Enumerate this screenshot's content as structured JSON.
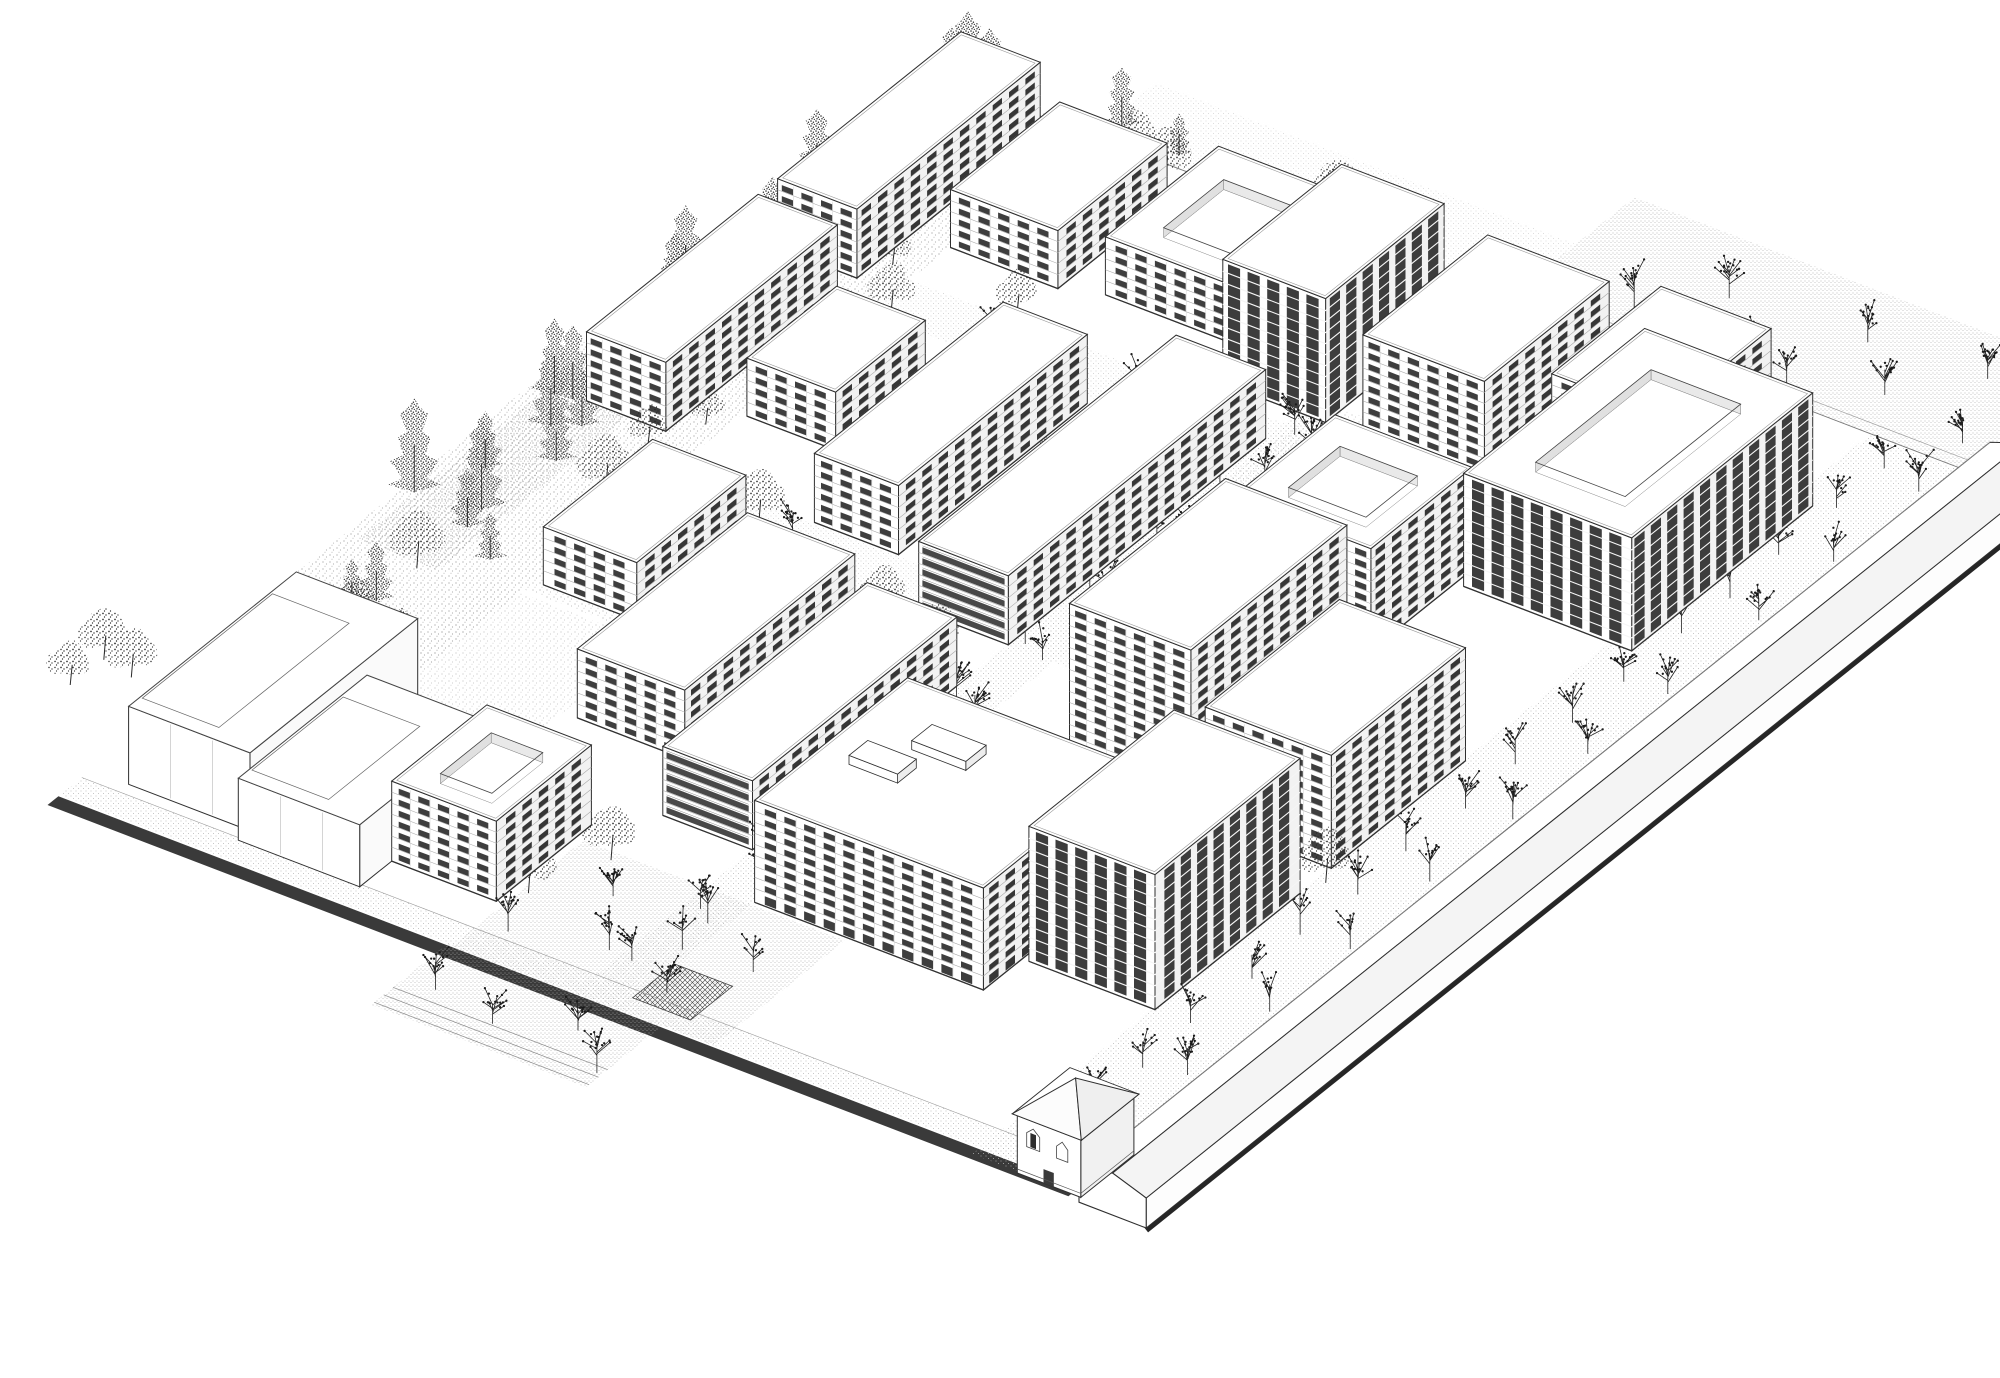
{
  "meta": {
    "drawing_kind": "black-and-white axonometric architectural masterplan line drawing",
    "width": 2000,
    "height": 1378,
    "visible_text": ""
  },
  "palette": {
    "paper": "#ffffff",
    "ink": "#2f2f2f",
    "line_light": "#a6a6a6",
    "facade_left": "#ffffff",
    "facade_right": "#f2f2f2",
    "window": "#2e2e2e",
    "window_right": "#262626",
    "dark_stripe": "#3d3d3d",
    "plinth_band": "#3a3a3a",
    "wall_shadow": "#262626",
    "trunk": "#2a2a2a"
  },
  "scene": {
    "axes": {
      "origin": [
        60,
        795
      ],
      "u": [
        0.934,
        0.358
      ],
      "v": [
        0.78,
        -0.625
      ]
    },
    "floor_height": 11,
    "bay_width": 21,
    "site": {
      "x_max": 1093,
      "y_max": 1140
    },
    "ground_patches": [
      {
        "name": "park-strip",
        "x": [
          -30,
          150
        ],
        "y": [
          130,
          1148
        ],
        "fill": "url(#speckLight)",
        "opacity": 0.9
      },
      {
        "name": "park-scrub",
        "x": [
          -15,
          70
        ],
        "y": [
          400,
          1140
        ],
        "fill": "url(#speckMed)",
        "opacity": 0.35
      },
      {
        "name": "sidewalk-south",
        "x": [
          0,
          1093
        ],
        "y": [
          0,
          28
        ],
        "fill": "url(#paveDots)",
        "opacity": 1
      },
      {
        "name": "plinth-dark-band",
        "x": [
          0,
          1093
        ],
        "y": [
          -16,
          -2
        ],
        "fill": "#3a3a3a",
        "opacity": 1
      },
      {
        "name": "forecourt",
        "x": [
          415,
          645
        ],
        "y": [
          -98,
          0
        ],
        "fill": "url(#paveDense)",
        "opacity": 1
      },
      {
        "name": "plaza-south",
        "x": [
          420,
          700
        ],
        "y": [
          0,
          168
        ],
        "fill": "url(#paveDense)",
        "opacity": 1
      },
      {
        "name": "avenue",
        "x": [
          551,
          600
        ],
        "y": [
          0,
          930
        ],
        "fill": "url(#paveDots)",
        "opacity": 1
      },
      {
        "name": "cross-street-a",
        "x": [
          150,
          1000
        ],
        "y": [
          556,
          606
        ],
        "fill": "url(#paveDots)",
        "opacity": 0.7
      },
      {
        "name": "cross-street-b",
        "x": [
          150,
          1000
        ],
        "y": [
          858,
          910
        ],
        "fill": "url(#paveDots)",
        "opacity": 0.7
      },
      {
        "name": "wall-street",
        "x": [
          985,
          1095
        ],
        "y": [
          -10,
          1140
        ],
        "fill": "url(#paveDots)",
        "opacity": 1
      },
      {
        "name": "plaza-northeast",
        "x": [
          600,
          1093
        ],
        "y": [
          1142,
          1300
        ],
        "fill": "url(#paveDense)",
        "opacity": 1
      },
      {
        "name": "walk-north",
        "x": [
          150,
          600
        ],
        "y": [
          1142,
          1225
        ],
        "fill": "url(#paveDots)",
        "opacity": 0.6
      },
      {
        "name": "courtyard-green-1",
        "x": [
          150,
          450
        ],
        "y": [
          415,
          550
        ],
        "fill": "url(#speckLight)",
        "opacity": 0.7
      },
      {
        "name": "courtyard-green-2",
        "x": [
          120,
          290
        ],
        "y": [
          250,
          410
        ],
        "fill": "url(#speckLight)",
        "opacity": 0.55
      },
      {
        "name": "courtyard-green-3",
        "x": [
          560,
          700
        ],
        "y": [
          690,
          950
        ],
        "fill": "url(#speckLight)",
        "opacity": 0.5
      },
      {
        "name": "plaza-canopy",
        "x": [
          598,
          660
        ],
        "y": [
          18,
          72
        ],
        "fill": "url(#hatchDark)",
        "opacity": 1,
        "stroke": "#444444"
      }
    ],
    "ground_lines": [
      {
        "name": "ne-boundary",
        "from": [
          150,
          1142
        ],
        "to": [
          1093,
          1142
        ],
        "w": 0.9,
        "color": "#777777"
      },
      {
        "name": "ne-boundary-2",
        "from": [
          600,
          1154
        ],
        "to": [
          1093,
          1154
        ],
        "w": 0.6,
        "color": "#9a9a9a"
      },
      {
        "name": "sidewalk-edge",
        "from": [
          0,
          28
        ],
        "to": [
          1093,
          28
        ],
        "w": 0.6,
        "color": "#9a9a9a"
      },
      {
        "name": "forecourt-step-1",
        "from": [
          415,
          -70
        ],
        "to": [
          645,
          -70
        ],
        "w": 0.7,
        "color": "#888888"
      },
      {
        "name": "forecourt-step-2",
        "from": [
          415,
          -82
        ],
        "to": [
          645,
          -82
        ],
        "w": 0.7,
        "color": "#888888"
      },
      {
        "name": "forecourt-step-3",
        "from": [
          415,
          -94
        ],
        "to": [
          645,
          -94
        ],
        "w": 0.7,
        "color": "#888888"
      },
      {
        "name": "plaza-ne-dark-edge",
        "from": [
          1093,
          1142
        ],
        "to": [
          1093,
          1300
        ],
        "w": 4.5,
        "color": "#2a2a2a"
      }
    ],
    "context_buildings": [
      {
        "id": "context-rear",
        "x": 40,
        "y": 40,
        "wx": 130,
        "wy": 215,
        "h": 78
      },
      {
        "id": "context-front",
        "x": 170,
        "y": 25,
        "wx": 130,
        "wy": 165,
        "h": 62
      }
    ],
    "buildings": [
      {
        "id": "nw-slab-a",
        "x": 25,
        "y": 890,
        "wx": 85,
        "wy": 235,
        "floors": 6,
        "style": "punched"
      },
      {
        "id": "top-b",
        "x": 150,
        "y": 962,
        "wx": 115,
        "wy": 140,
        "floors": 5,
        "style": "punched"
      },
      {
        "id": "top-c",
        "x": 305,
        "y": 975,
        "wx": 140,
        "wy": 145,
        "floors": 5,
        "style": "punched",
        "court": true
      },
      {
        "id": "w-slab-b",
        "x": 25,
        "y": 645,
        "wx": 85,
        "wy": 220,
        "floors": 6,
        "style": "punched"
      },
      {
        "id": "mid-left",
        "x": 155,
        "y": 695,
        "wx": 95,
        "wy": 115,
        "floors": 5,
        "style": "punched"
      },
      {
        "id": "center-slab",
        "x": 300,
        "y": 608,
        "wx": 90,
        "wy": 242,
        "floors": 6,
        "style": "punched"
      },
      {
        "id": "left-low",
        "x": 160,
        "y": 428,
        "wx": 100,
        "wy": 140,
        "floors": 5,
        "style": "punched"
      },
      {
        "id": "center-low",
        "x": 305,
        "y": 298,
        "wx": 115,
        "wy": 218,
        "floors": 6,
        "style": "punched"
      },
      {
        "id": "row-north",
        "x": 455,
        "y": 556,
        "wx": 96,
        "wy": 330,
        "floors": 6,
        "style": "bands"
      },
      {
        "id": "row-south",
        "x": 455,
        "y": 228,
        "wx": 96,
        "wy": 262,
        "floors": 6,
        "style": "bands"
      },
      {
        "id": "terrace-sw",
        "x": 300,
        "y": 66,
        "wx": 112,
        "wy": 122,
        "floors": 7,
        "style": "punched",
        "court": true
      },
      {
        "id": "south-big",
        "x": 600,
        "y": 172,
        "wx": 245,
        "wy": 196,
        "floors": 9,
        "style": "punched",
        "shop": true,
        "roofboxes": [
          [
            668,
            292,
            58,
            26,
            9
          ],
          [
            636,
            250,
            52,
            24,
            9
          ]
        ]
      },
      {
        "id": "tower-s",
        "x": 852,
        "y": 222,
        "wx": 135,
        "wy": 186,
        "floors": 12,
        "style": "dark",
        "shop": true
      },
      {
        "id": "mid-e",
        "x": 852,
        "y": 448,
        "wx": 135,
        "wy": 172,
        "floors": 10,
        "style": "punched"
      },
      {
        "id": "tower-c",
        "x": 690,
        "y": 468,
        "wx": 130,
        "wy": 200,
        "floors": 13,
        "style": "punched"
      },
      {
        "id": "court-e",
        "x": 828,
        "y": 808,
        "wx": 180,
        "wy": 232,
        "floors": 10,
        "style": "dark",
        "court": true
      },
      {
        "id": "terrace-e",
        "x": 672,
        "y": 700,
        "wx": 147,
        "wy": 130,
        "floors": 9,
        "style": "punched",
        "court": true
      },
      {
        "id": "n-tower",
        "x": 470,
        "y": 928,
        "wx": 110,
        "wy": 152,
        "floors": 11,
        "style": "dark"
      },
      {
        "id": "ne-mid",
        "x": 610,
        "y": 940,
        "wx": 130,
        "wy": 160,
        "floors": 8,
        "style": "punched"
      },
      {
        "id": "ne-corner",
        "x": 762,
        "y": 1000,
        "wx": 118,
        "wy": 140,
        "floors": 6,
        "style": "punched"
      }
    ],
    "wall": {
      "x0": 1106,
      "x1": 1178,
      "y0": -18,
      "y1": 1150,
      "h": 30,
      "ridge": 12
    },
    "gatehouse": {
      "x0": 1035,
      "x1": 1103,
      "y0": -12,
      "y1": 56,
      "h": 60,
      "apex": 26
    },
    "tree_bands": [
      {
        "name": "nw-conifer-band",
        "x": [
          -18,
          68
        ],
        "y": [
          430,
          1150
        ],
        "n": 26,
        "type": "conifer",
        "h": [
          52,
          95
        ],
        "seed": 7
      },
      {
        "name": "w-mixed-band",
        "x": [
          -5,
          135
        ],
        "y": [
          140,
          440
        ],
        "n": 13,
        "type": "mixed",
        "h": [
          38,
          70
        ],
        "seed": 11
      },
      {
        "name": "n-mixed-band",
        "x": [
          140,
          430
        ],
        "y": [
          1075,
          1165
        ],
        "n": 12,
        "type": "mixed",
        "h": [
          36,
          64
        ],
        "seed": 23
      },
      {
        "name": "sw-outside-trees",
        "x": [
          -95,
          -35
        ],
        "y": [
          90,
          170
        ],
        "n": 3,
        "type": "park",
        "h": [
          40,
          60
        ],
        "seed": 31
      },
      {
        "name": "park-fill",
        "x": [
          60,
          150
        ],
        "y": [
          520,
          1000
        ],
        "n": 8,
        "type": "park",
        "h": [
          34,
          52
        ],
        "seed": 41
      }
    ],
    "courtyard_trees": [
      [
        165,
        868
      ],
      [
        258,
        918
      ],
      [
        120,
        556
      ],
      [
        262,
        582
      ],
      [
        428,
        756
      ],
      [
        432,
        538
      ],
      [
        618,
        618
      ],
      [
        648,
        414
      ],
      [
        282,
        228
      ],
      [
        428,
        88
      ],
      [
        458,
        158
      ],
      [
        836,
        676
      ],
      [
        996,
        430
      ],
      [
        658,
        876
      ],
      [
        505,
        520
      ],
      [
        700,
        940
      ]
    ],
    "street_tree_rows": [
      {
        "name": "wall-street-row-1",
        "x": 1028,
        "y0": 25,
        "y1": 1120,
        "step": 68
      },
      {
        "name": "wall-street-row-2",
        "x": 1072,
        "y0": 55,
        "y1": 1110,
        "step": 104
      },
      {
        "name": "avenue-row-1",
        "x": 566,
        "y0": 55,
        "y1": 920,
        "step": 84
      },
      {
        "name": "avenue-row-2",
        "x": 590,
        "y0": 95,
        "y1": 920,
        "step": 92
      }
    ],
    "street_trees": [
      [
        448,
        38
      ],
      [
        492,
        120
      ],
      [
        538,
        60
      ],
      [
        585,
        130
      ],
      [
        618,
        38
      ],
      [
        662,
        96
      ],
      [
        448,
        -55
      ],
      [
        520,
        -68
      ],
      [
        588,
        -40
      ],
      [
        640,
        -78
      ],
      [
        700,
        1180
      ],
      [
        760,
        1230
      ],
      [
        830,
        1180
      ],
      [
        900,
        1240
      ],
      [
        960,
        1190
      ],
      [
        1020,
        1250
      ],
      [
        1060,
        1170
      ],
      [
        880,
        1160
      ],
      [
        300,
        580
      ],
      [
        460,
        578
      ],
      [
        760,
        582
      ],
      [
        900,
        578
      ],
      [
        260,
        884
      ],
      [
        420,
        880
      ],
      [
        600,
        886
      ],
      [
        780,
        882
      ]
    ]
  }
}
